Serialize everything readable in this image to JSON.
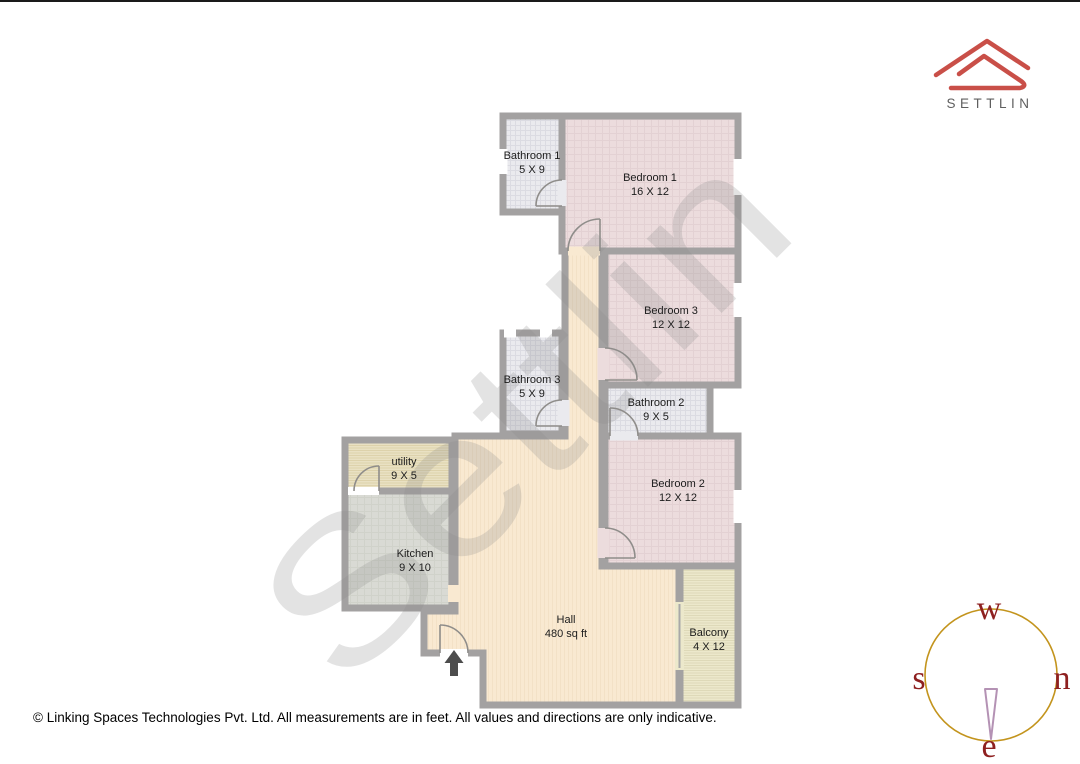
{
  "brand": {
    "name": "SETTLIN"
  },
  "watermark": "Settlin",
  "rooms": [
    {
      "name": "Bathroom 1",
      "dims": "5 X 9"
    },
    {
      "name": "Bedroom 1",
      "dims": "16 X 12"
    },
    {
      "name": "Bedroom 3",
      "dims": "12 X 12"
    },
    {
      "name": "Bathroom 3",
      "dims": "5 X 9"
    },
    {
      "name": "Bathroom 2",
      "dims": "9 X 5"
    },
    {
      "name": "Bedroom 2",
      "dims": "12 X 12"
    },
    {
      "name": "utility",
      "dims": "9 X 5"
    },
    {
      "name": "Kitchen",
      "dims": "9 X 10"
    },
    {
      "name": "Hall",
      "dims": "480 sq ft"
    },
    {
      "name": "Balcony",
      "dims": "4 X 12"
    }
  ],
  "compass": {
    "top": "w",
    "left": "s",
    "right": "n",
    "bottom": "e"
  },
  "footer": {
    "text": "© Linking Spaces Technologies Pvt. Ltd. All measurements are in feet. All values and directions are only indicative."
  },
  "colors": {
    "wall": "#a3a1a1",
    "bathroom_floor": "#eaeaee",
    "bedroom_floor": "#ecdcdd",
    "hall_floor": "#f9e9d1",
    "utility_floor": "#e9e1c3",
    "kitchen_floor": "#d9dad4",
    "balcony_floor": "#ece8cb",
    "logo_red": "#c94f48",
    "compass_circle": "#c3941d",
    "compass_letters": "#8e2020",
    "compass_needle": "#b492b4",
    "entrance_arrow": "#4d4d4d"
  }
}
